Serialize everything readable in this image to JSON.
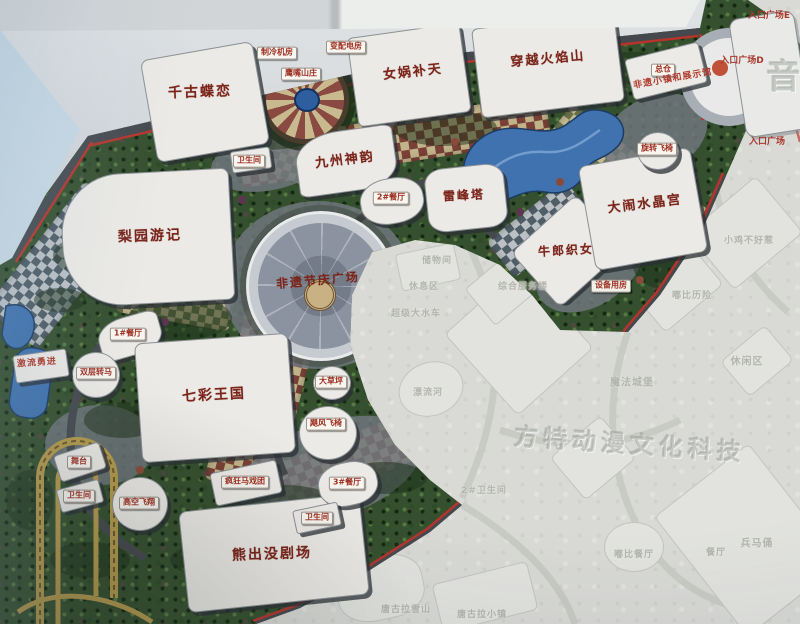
{
  "map": {
    "labels": {
      "attractions": [
        {
          "t": "千古蝶恋",
          "x": 200,
          "y": 93,
          "fs": 14,
          "r": -2
        },
        {
          "t": "女娲补天",
          "x": 413,
          "y": 73,
          "fs": 13,
          "r": -6
        },
        {
          "t": "穿越火焰山",
          "x": 548,
          "y": 60,
          "fs": 13,
          "r": -5
        },
        {
          "t": "九州神韵",
          "x": 345,
          "y": 161,
          "fs": 13,
          "r": -7
        },
        {
          "t": "雷峰塔",
          "x": 464,
          "y": 196,
          "fs": 12,
          "r": -3
        },
        {
          "t": "牛郎织女",
          "x": 566,
          "y": 251,
          "fs": 12,
          "r": -3
        },
        {
          "t": "大闹水晶宫",
          "x": 645,
          "y": 205,
          "fs": 13,
          "r": -7
        },
        {
          "t": "梨园游记",
          "x": 150,
          "y": 237,
          "fs": 14,
          "r": -2
        },
        {
          "t": "非遗节庆广场",
          "x": 318,
          "y": 281,
          "fs": 12,
          "r": -5
        },
        {
          "t": "七彩王国",
          "x": 214,
          "y": 396,
          "fs": 14,
          "r": -3
        },
        {
          "t": "熊出没剧场",
          "x": 272,
          "y": 555,
          "fs": 14,
          "r": -2
        }
      ],
      "facilities": [
        {
          "t": "总仓",
          "x": 663,
          "y": 70
        },
        {
          "t": "制冷机房",
          "x": 277,
          "y": 53
        },
        {
          "t": "变配电房",
          "x": 346,
          "y": 47
        },
        {
          "t": "鹰嘴山庄",
          "x": 301,
          "y": 74
        },
        {
          "t": "卫生间",
          "x": 22,
          "y": 166
        },
        {
          "t": "卫生间",
          "x": 249,
          "y": 161
        },
        {
          "t": "2#餐厅",
          "x": 391,
          "y": 198
        },
        {
          "t": "1#餐厅",
          "x": 128,
          "y": 334
        },
        {
          "t": "大草坪",
          "x": 331,
          "y": 382
        },
        {
          "t": "双层转马",
          "x": 96,
          "y": 373
        },
        {
          "t": "舞台",
          "x": 79,
          "y": 462
        },
        {
          "t": "卫生间",
          "x": 79,
          "y": 496
        },
        {
          "t": "高空飞翔",
          "x": 139,
          "y": 503
        },
        {
          "t": "疯狂马戏团",
          "x": 245,
          "y": 482
        },
        {
          "t": "3#餐厅",
          "x": 347,
          "y": 483
        },
        {
          "t": "卫生间",
          "x": 317,
          "y": 518
        },
        {
          "t": "飓风飞椅",
          "x": 326,
          "y": 424
        },
        {
          "t": "旋转飞椅",
          "x": 657,
          "y": 149
        },
        {
          "t": "设备用房",
          "x": 611,
          "y": 286
        }
      ],
      "red_notes": [
        {
          "t": "激流勇进",
          "x": 37,
          "y": 364,
          "r": -4
        },
        {
          "t": "非遗小镇和展示馆",
          "x": 673,
          "y": 80,
          "r": -10
        }
      ],
      "entrances": [
        {
          "t": "入口广场E",
          "x": 769,
          "y": 17
        },
        {
          "t": "入口广场D",
          "x": 742,
          "y": 62
        },
        {
          "t": "入口广场",
          "x": 767,
          "y": 143
        }
      ],
      "faded": [
        {
          "t": "储物间",
          "x": 437,
          "y": 262
        },
        {
          "t": "休息区",
          "x": 424,
          "y": 288
        },
        {
          "t": "综合服务楼",
          "x": 523,
          "y": 288
        },
        {
          "t": "超级大水车",
          "x": 416,
          "y": 315
        },
        {
          "t": "漂流河",
          "x": 428,
          "y": 394
        },
        {
          "t": "2#卫生间",
          "x": 484,
          "y": 492
        },
        {
          "t": "魔法城堡",
          "x": 632,
          "y": 383,
          "fs": 10
        },
        {
          "t": "休闲区",
          "x": 747,
          "y": 362,
          "fs": 10
        },
        {
          "t": "嘟比历险",
          "x": 692,
          "y": 297
        },
        {
          "t": "小鸡不好惹",
          "x": 749,
          "y": 242
        },
        {
          "t": "兵马俑",
          "x": 757,
          "y": 544,
          "fs": 10
        },
        {
          "t": "嘟比餐厅",
          "x": 634,
          "y": 556
        },
        {
          "t": "餐厅",
          "x": 716,
          "y": 554
        },
        {
          "t": "唐古拉雪山",
          "x": 406,
          "y": 611
        },
        {
          "t": "唐古拉小镇",
          "x": 482,
          "y": 616
        }
      ]
    },
    "watermarks": [
      {
        "t": "方特动漫文化科技",
        "x": 630,
        "y": 445,
        "fs": 24,
        "r": 4
      },
      {
        "t": "音",
        "x": 786,
        "y": 78,
        "fs": 34,
        "r": 0
      }
    ],
    "colors": {
      "accent_red": "#b5342c",
      "label_red": "#9c2d1f",
      "faded_text": "#b2b5ad",
      "water": "#3f72ae",
      "foliage": "#35502e",
      "paving_maroon": "#7e4038",
      "paving_tan": "#c9b98f"
    }
  }
}
